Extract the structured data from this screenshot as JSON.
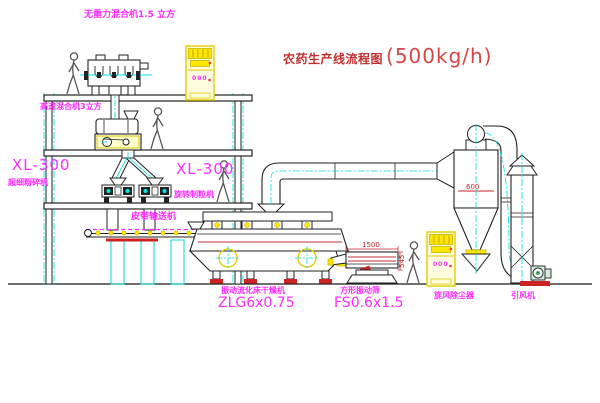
{
  "title": {
    "name": "农药生产线流程图",
    "capacity": "(500kg/h)"
  },
  "equipment_labels": {
    "gravity_free_mixer": "无重力混合机1.5 立方",
    "high_speed_mixer": "高速混合机3立方",
    "left_unit_model": "XL-300",
    "left_unit_name": "超细粉碎机",
    "right_unit_model": "XL-300",
    "right_unit_name": "旋转制粒机",
    "belt_conveyor": "皮带输送机",
    "dryer_name": "振动流化床干燥机",
    "dryer_model": "ZLG6x0.75",
    "screen_name": "方形振动筛",
    "screen_model": "FS0.6x1.5",
    "cyclone": "旋风除尘器",
    "fan": "引风机"
  },
  "annotations": {
    "screen_length": "1500",
    "screen_height": "545",
    "cyclone_marking": "600",
    "cabinet1_display": "000",
    "cabinet2_display": "000"
  },
  "colors": {
    "label_magenta": "#ff2bff",
    "title_red": "#c03030",
    "line_black": "#222222",
    "accent_cyan": "#00e0e0",
    "accent_yellow": "#ffe800",
    "accent_red": "#cc2222"
  }
}
